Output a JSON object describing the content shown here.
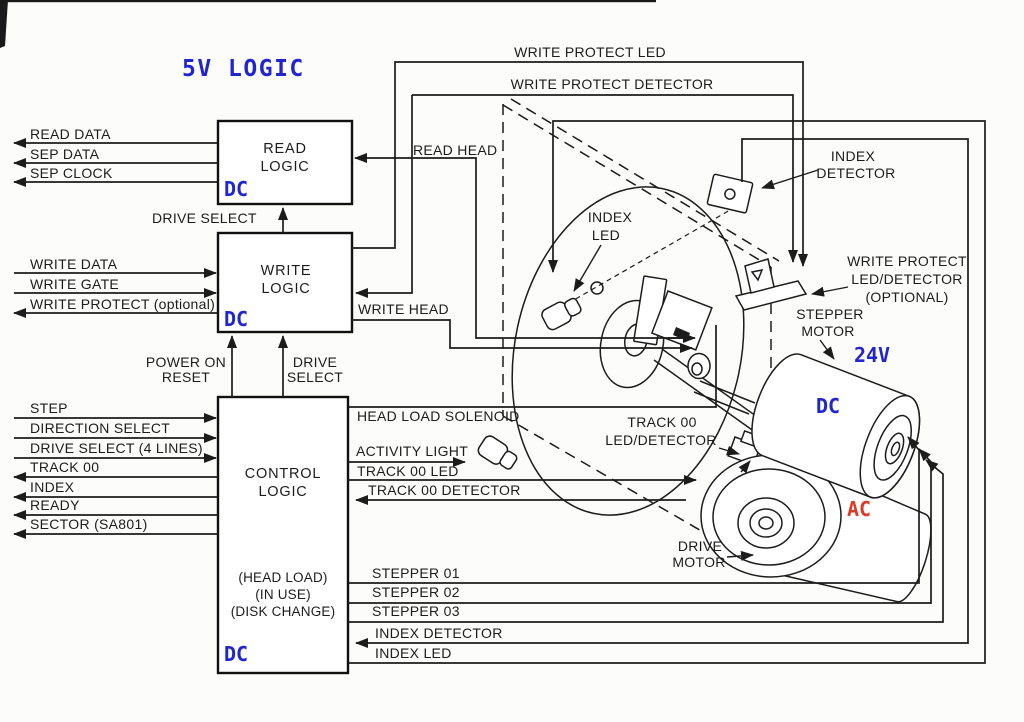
{
  "title": "5V LOGIC",
  "colors": {
    "logic_blue": "#2125cf",
    "ac_red": "#d93b27",
    "line": "#1c1c1c",
    "background": "#fcfcfa"
  },
  "blocks": {
    "read": {
      "l1": "READ",
      "l2": "LOGIC",
      "dc": "DC"
    },
    "write": {
      "l1": "WRITE",
      "l2": "LOGIC",
      "dc": "DC"
    },
    "control": {
      "l1": "CONTROL",
      "l2": "LOGIC",
      "sub": [
        "(HEAD LOAD)",
        "(IN USE)",
        "(DISK CHANGE)"
      ],
      "dc": "DC"
    }
  },
  "bus": {
    "read": [
      "READ DATA",
      "SEP DATA",
      "SEP CLOCK"
    ],
    "write": [
      "WRITE DATA",
      "WRITE GATE",
      "WRITE PROTECT (optional)"
    ],
    "control_in": [
      "STEP",
      "DIRECTION SELECT",
      "DRIVE SELECT (4 LINES)"
    ],
    "control_out": [
      "TRACK 00",
      "INDEX",
      "READY",
      "SECTOR (SA801)"
    ]
  },
  "internal": {
    "drive_select_top": "DRIVE SELECT",
    "power_on_reset": [
      "POWER ON",
      "RESET"
    ],
    "drive_select_mid": [
      "DRIVE",
      "SELECT"
    ],
    "write_protect_led": "WRITE PROTECT LED",
    "write_protect_detector": "WRITE PROTECT DETECTOR",
    "read_head": "READ HEAD",
    "write_head": "WRITE HEAD",
    "head_load_solenoid": "HEAD LOAD SOLENOID",
    "activity_light": "ACTIVITY LIGHT",
    "track00_led": "TRACK 00 LED",
    "track00_detector": "TRACK 00 DETECTOR",
    "stepper": [
      "STEPPER 01",
      "STEPPER 02",
      "STEPPER 03"
    ],
    "index_detector": "INDEX DETECTOR",
    "index_led": "INDEX LED"
  },
  "mech": {
    "index_detector": [
      "INDEX",
      "DETECTOR"
    ],
    "index_led": [
      "INDEX",
      "LED"
    ],
    "write_protect": [
      "WRITE PROTECT",
      "LED/DETECTOR",
      "(OPTIONAL)"
    ],
    "stepper_motor": [
      "STEPPER",
      "MOTOR"
    ],
    "track00": [
      "TRACK 00",
      "LED/DETECTOR"
    ],
    "drive_motor": [
      "DRIVE",
      "MOTOR"
    ],
    "volt_24": "24V",
    "dc": "DC",
    "ac": "AC"
  }
}
